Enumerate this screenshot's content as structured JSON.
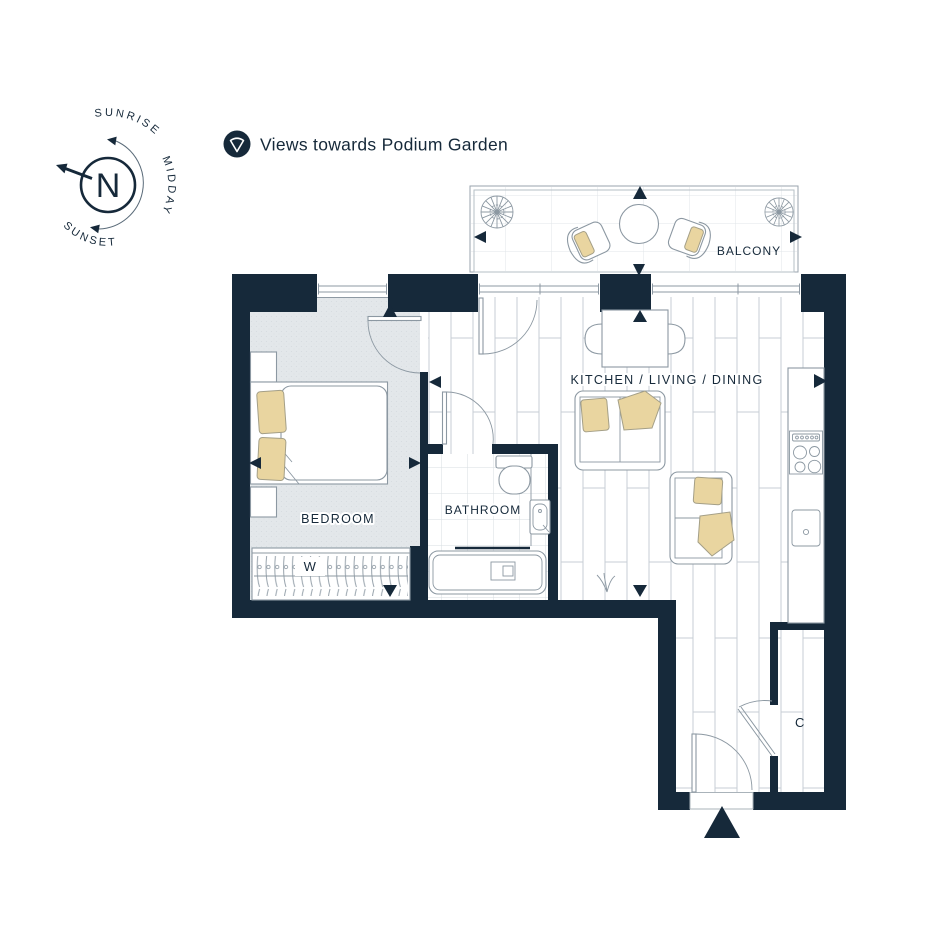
{
  "colors": {
    "wall": "#16293a",
    "cushion": "#e9d5a0",
    "cushion-stroke": "#a49f87",
    "fstroke": "#8c98a2",
    "carpet": "#e3e7ea",
    "floor-line": "#c7ced4",
    "tile-line": "#d7dde1"
  },
  "legend": {
    "icon": "view-cone-icon",
    "label": "Views towards Podium Garden"
  },
  "compass": {
    "north_label": "N",
    "sunrise_label": "SUNRISE",
    "midday_label": "MIDDAY",
    "sunset_label": "SUNSET"
  },
  "floorplan": {
    "rooms": {
      "bedroom": {
        "label": "BEDROOM"
      },
      "bathroom": {
        "label": "BATHROOM"
      },
      "kitchen_living_dining": {
        "label": "KITCHEN / LIVING / DINING"
      },
      "balcony": {
        "label": "BALCONY"
      }
    },
    "wardrobe_label": "W",
    "cupboard_label": "C",
    "view_marker_symbol": "solid-triangle"
  }
}
